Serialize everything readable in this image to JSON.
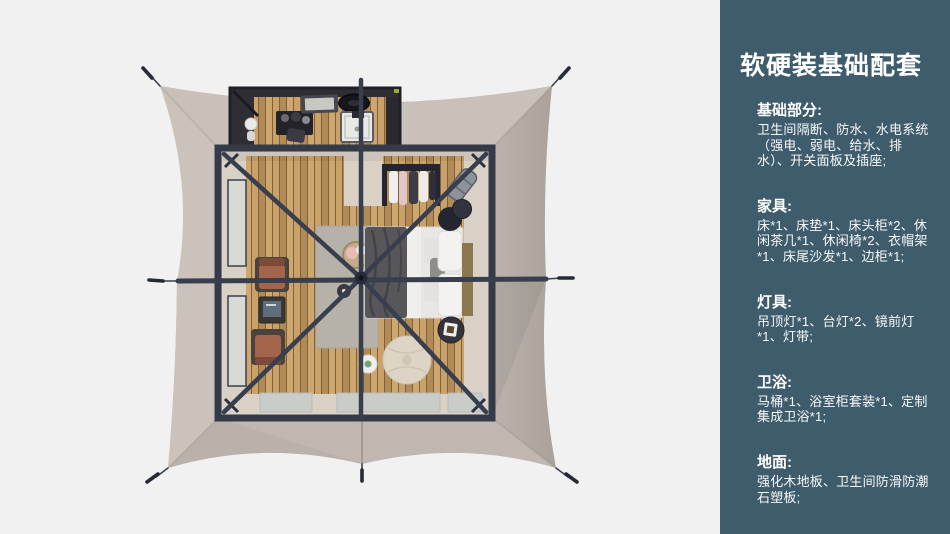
{
  "canvas": {
    "width": 950,
    "height": 534,
    "background": "#f1f1f2"
  },
  "sidebar": {
    "background": "#3e5c6c",
    "text_color": "#ffffff",
    "title": "软硬装基础配套",
    "sections": [
      {
        "heading": "基础部分:",
        "body": "卫生间隔断、防水、水电系统（强电、弱电、给水、排水）、开关面板及插座;"
      },
      {
        "heading": "家具:",
        "body": "床*1、床垫*1、床头柜*2、休闲茶几*1、休闲椅*2、衣帽架*1、床尾沙发*1、边柜*1;"
      },
      {
        "heading": "灯具:",
        "body": "吊顶灯*1、台灯*2、镜前灯*1、灯带;"
      },
      {
        "heading": "卫浴:",
        "body": "马桶*1、浴室柜套装*1、定制集成卫浴*1;"
      },
      {
        "heading": "地面:",
        "body": "强化木地板、卫生间防滑防潮石塑板;"
      }
    ]
  },
  "floorplan": {
    "kind": "top-down render of square safari tent suite with bathroom annex",
    "colors": {
      "canopy": "#c6beb6",
      "canopy_east_shade": "#b2aaa4",
      "canopy_south_shade": "#c0b8b0",
      "frame_beams": "#373e4d",
      "wood_floor": "#c59e66",
      "interior_wall_band": "#d9d1c6",
      "rug": "#b7b2a9",
      "bed_linen": "#e9e7e3",
      "blanket": "#57565b",
      "lounge_chair": "#a3654c",
      "pouf": "#ddd4c5",
      "entry_mats": "#c9cdca",
      "bathroom_walls": "#2f2e34"
    }
  }
}
